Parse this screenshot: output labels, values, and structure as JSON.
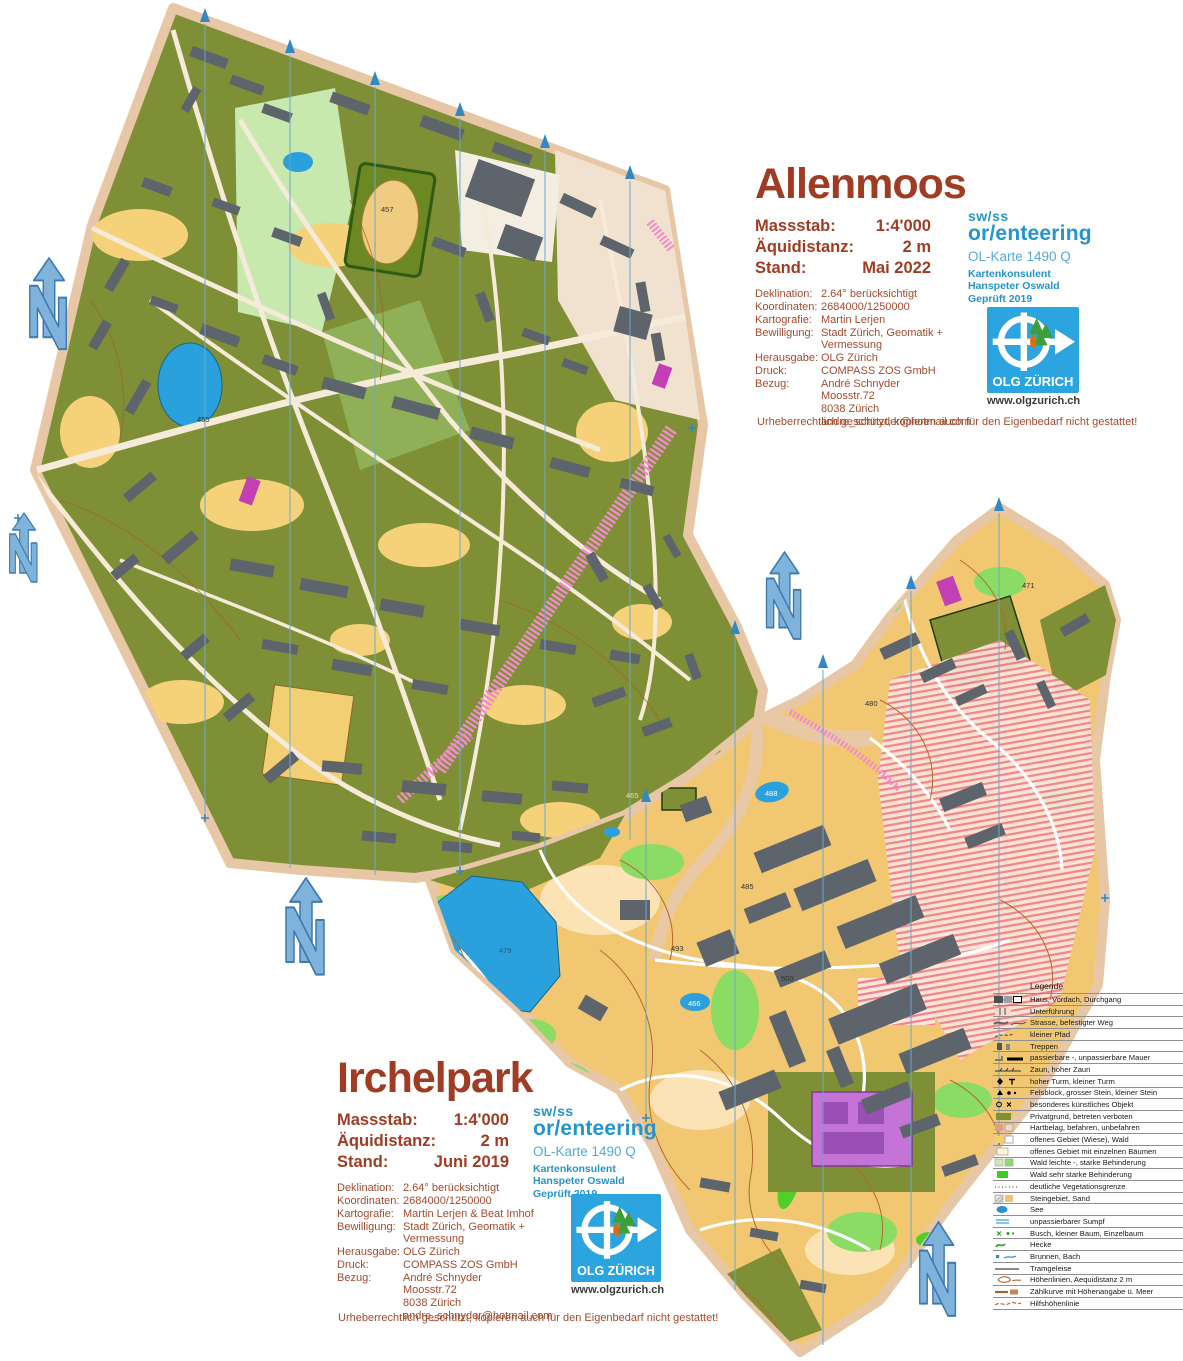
{
  "maps": {
    "allenmoos": {
      "title": "Allenmoos",
      "info": {
        "massstab_label": "Massstab:",
        "massstab": "1:4'000",
        "aequidistanz_label": "Äquidistanz:",
        "aequidistanz": "2 m",
        "stand_label": "Stand:",
        "stand": "Mai 2022"
      },
      "details": [
        {
          "label": "Deklination:",
          "value": "2.64° berücksichtigt"
        },
        {
          "label": "Koordinaten:",
          "value": "2684000/1250000"
        },
        {
          "label": "Kartografie:",
          "value": "Martin Lerjen"
        },
        {
          "label": "Bewilligung:",
          "value": "Stadt Zürich, Geomatik +\nVermessung"
        },
        {
          "label": "Herausgabe:",
          "value": "OLG Zürich"
        },
        {
          "label": "Druck:",
          "value": "COMPASS ZOS GmbH"
        },
        {
          "label": "Bezug:",
          "value": "André Schnyder\nMoosstr.72\n8038 Zürich\nandre_schnyder@hotmail.com"
        }
      ],
      "copyright": "Urheberrechtlich geschützt, kopieren auch für den Eigenbedarf nicht gestattet!",
      "spot_heights": {
        "s455": "455",
        "s457": "457"
      }
    },
    "irchelpark": {
      "title": "Irchelpark",
      "info": {
        "massstab_label": "Massstab:",
        "massstab": "1:4'000",
        "aequidistanz_label": "Äquidistanz:",
        "aequidistanz": "2 m",
        "stand_label": "Stand:",
        "stand": "Juni 2019"
      },
      "details": [
        {
          "label": "Deklination:",
          "value": "2.64° berücksichtigt"
        },
        {
          "label": "Koordinaten:",
          "value": "2684000/1250000"
        },
        {
          "label": "Kartografie:",
          "value": "Martin Lerjen & Beat Imhof"
        },
        {
          "label": "Bewilligung:",
          "value": "Stadt Zürich, Geomatik +\nVermessung"
        },
        {
          "label": "Herausgabe:",
          "value": "OLG Zürich"
        },
        {
          "label": "Druck:",
          "value": "COMPASS ZOS GmbH"
        },
        {
          "label": "Bezug:",
          "value": "André Schnyder\nMoosstr.72\n8038 Zürich\nandre_schnyder@hotmail.com"
        }
      ],
      "copyright": "Urheberrechtlich geschützt, kopieren auch für den Eigenbedarf nicht gestattet!",
      "spot_heights": {
        "s465": "465",
        "s466": "466",
        "s471": "471",
        "s479": "479",
        "s480": "480",
        "s485": "485",
        "s488": "488",
        "s493": "493",
        "s500": "500"
      }
    }
  },
  "logos": {
    "swiss_orienteering": {
      "line1": "sw/ss",
      "line2": "or/enteering",
      "subtitle": "OL-Karte 1490 Q",
      "consultant_role": "Kartenkonsulent",
      "consultant_name": "Hanspeter Oswald",
      "checked": "Geprüft 2019"
    },
    "olg": {
      "name": "OLG ZÜRICH",
      "url": "www.olgzurich.ch"
    }
  },
  "legend": {
    "title": "Legende",
    "items": [
      {
        "symbol": "haus-vordach-durchgang",
        "label": "Haus, Vordach, Durchgang"
      },
      {
        "symbol": "unterfuehrung",
        "label": "Unterführung"
      },
      {
        "symbol": "strasse-befestigter-weg",
        "label": "Strasse, befestigter Weg"
      },
      {
        "symbol": "kleiner-pfad",
        "label": "kleiner Pfad"
      },
      {
        "symbol": "treppen",
        "label": "Treppen"
      },
      {
        "symbol": "mauer",
        "label": "passierbare -, unpassierbare Mauer"
      },
      {
        "symbol": "zaun",
        "label": "Zaun, hoher Zaun"
      },
      {
        "symbol": "turm",
        "label": "hoher Turm, kleiner Turm"
      },
      {
        "symbol": "felsblock-stein",
        "label": "Felsblock, grosser Stein, kleiner Stein"
      },
      {
        "symbol": "kuenstliches-objekt",
        "label": "besonderes künstliches Objekt"
      },
      {
        "symbol": "privatgrund",
        "label": "Privatgrund, betreten verboten"
      },
      {
        "symbol": "hartbelag",
        "label": "Hartbelag, befahren, unbefahren"
      },
      {
        "symbol": "offenes-gebiet-wald",
        "label": "offenes Gebiet (Wiese), Wald"
      },
      {
        "symbol": "gebiet-einzelne-baeume",
        "label": "offenes Gebiet mit einzelnen Bäumen"
      },
      {
        "symbol": "wald-behinderung",
        "label": "Wald leichte -, starke Behinderung"
      },
      {
        "symbol": "wald-sehr-stark",
        "label": "Wald sehr starke Behinderung"
      },
      {
        "symbol": "vegetationsgrenze",
        "label": "deutliche Vegetationsgrenze"
      },
      {
        "symbol": "steingebiet-sand",
        "label": "Steingebiet, Sand"
      },
      {
        "symbol": "see",
        "label": "See"
      },
      {
        "symbol": "sumpf",
        "label": "unpassierbarer Sumpf"
      },
      {
        "symbol": "busch-baum",
        "label": "Busch, kleiner Baum, Einzelbaum"
      },
      {
        "symbol": "hecke",
        "label": "Hecke"
      },
      {
        "symbol": "brunnen-bach",
        "label": "Brunnen, Bach"
      },
      {
        "symbol": "tramgeleise",
        "label": "Tramgeleise"
      },
      {
        "symbol": "hoehenlinien",
        "label": "Höhenlinien, Aequidistanz 2 m"
      },
      {
        "symbol": "zaehlkurve",
        "label": "Zählkurve mit Höhenangabe ü. Meer"
      },
      {
        "symbol": "hilfshoehenlinie",
        "label": "Hilfshöhenlinie"
      }
    ]
  },
  "colors": {
    "title_red": "#a03c23",
    "detail_red": "#a34b2e",
    "swiss_blue": "#2494cd",
    "olg_blue": "#2ba4e0",
    "north_blue": "#7fb3dc",
    "olive": "#7e8f36",
    "sand": "#f2c772",
    "water": "#2aa0dc",
    "building_gray": "#5d646b",
    "paper_edge": "#e7c7a5"
  }
}
